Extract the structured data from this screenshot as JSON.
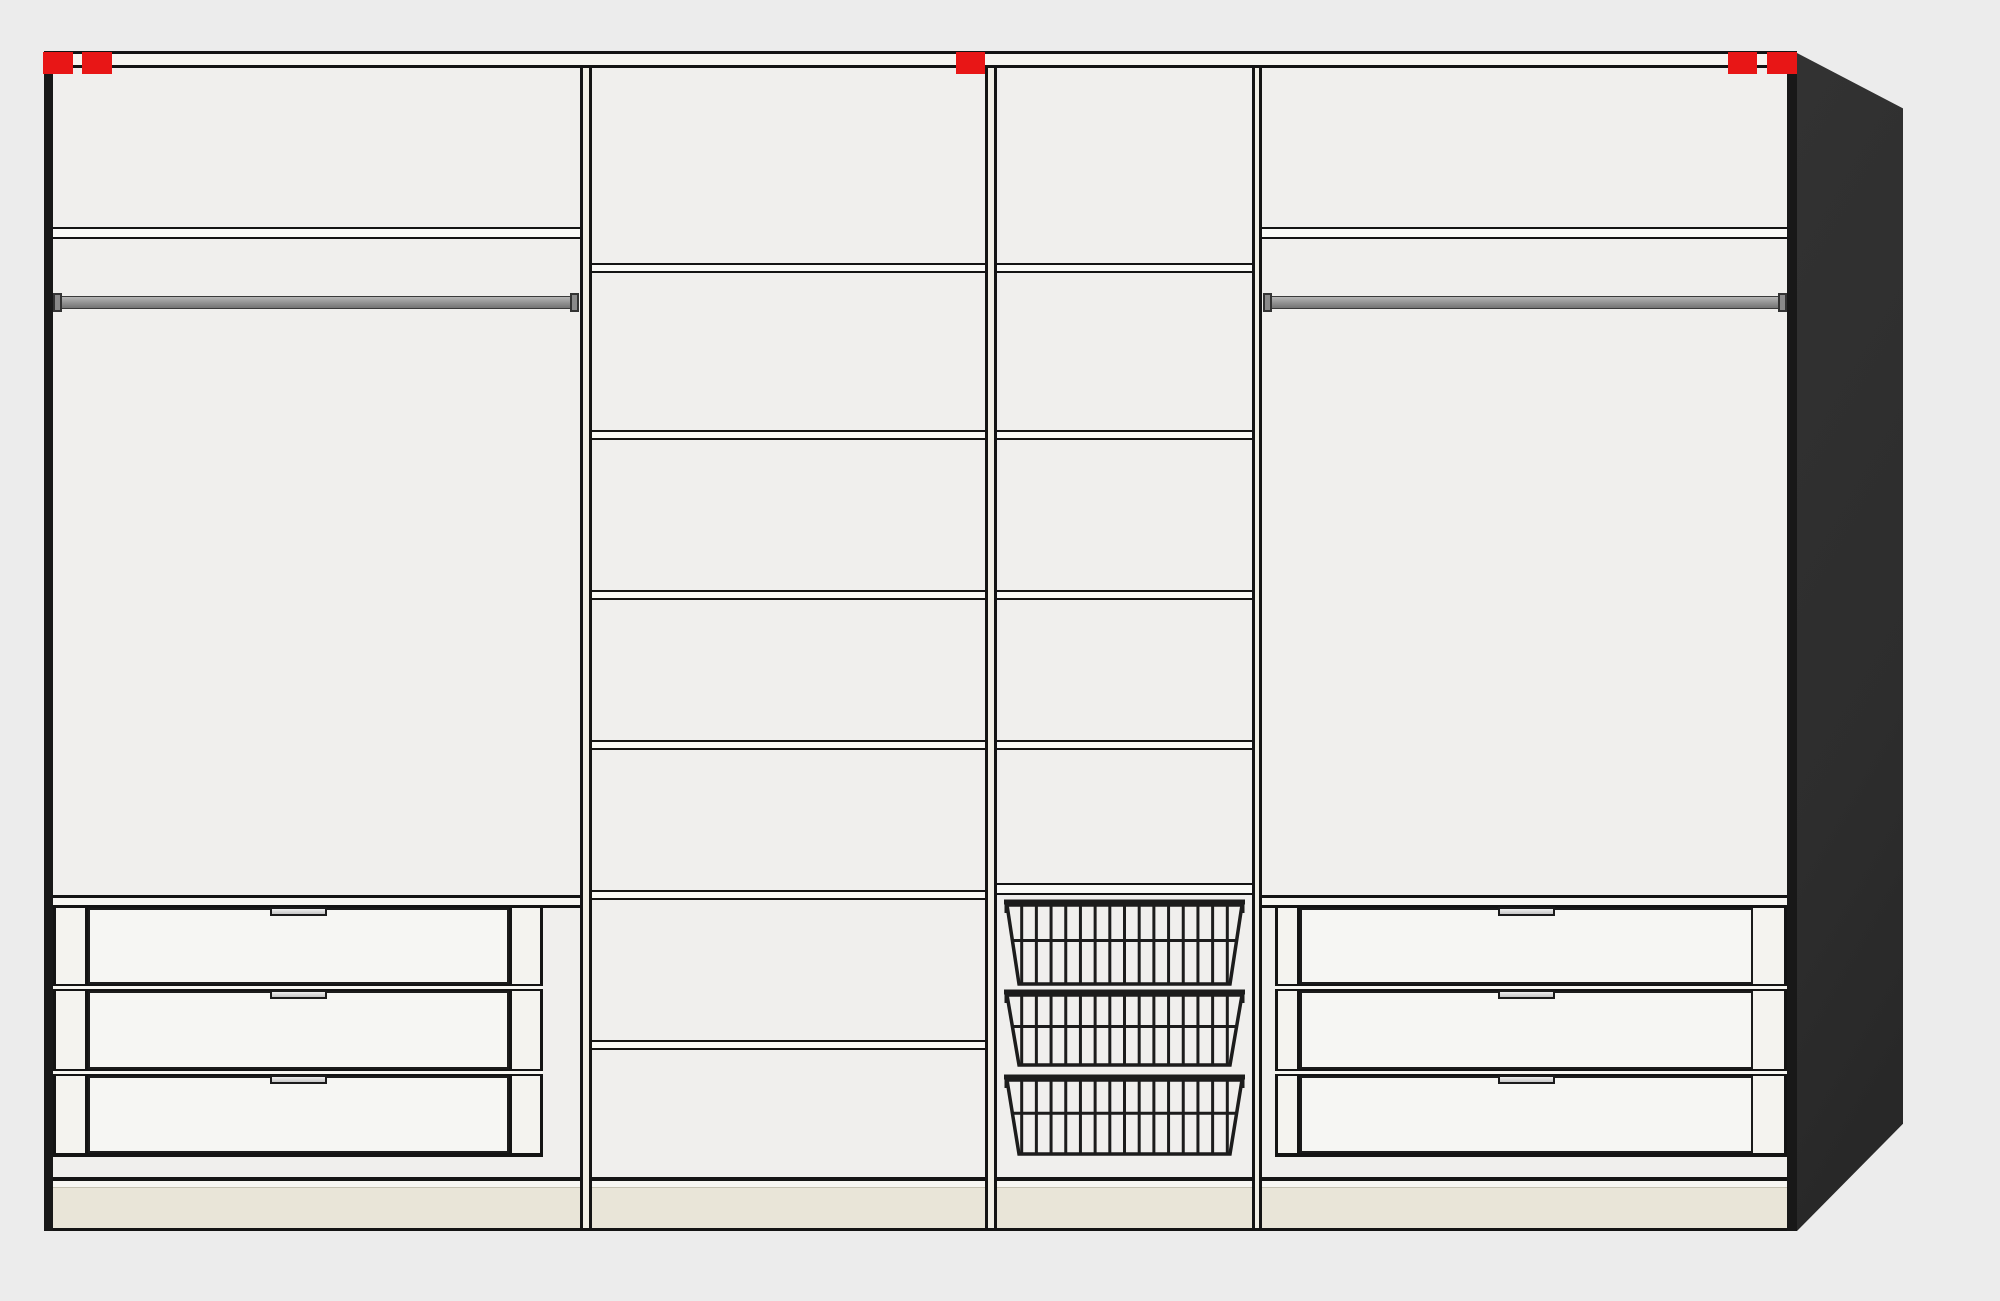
{
  "app": {
    "view": "wardrobe-front-elevation-preview",
    "description": "Schematic front view of a 4-section wardrobe interior with perspective side panel"
  },
  "palette": {
    "background": "#ececec",
    "interior": "#f0efed",
    "line_dark": "#141414",
    "wall_dark": "#181818",
    "carcass_white": "#f6f5f0",
    "divider_fill": "#f1efe6",
    "shelf_fill": "#fafaf7",
    "front_fill": "#f6f6f3",
    "column_fill": "#f4f3ef",
    "rail_band_fill": "#f7f6f2",
    "plinth_beige": "#e9e5d8",
    "plinth_edge": "#c5c1b2",
    "side_panel_dark": "#2d2d2d",
    "rod_light": "#b5b5b5",
    "rod_mid": "#909090",
    "rod_dark": "#747474",
    "rod_cap": "#8a8a8a",
    "handle_light": "#eeeeee",
    "handle_dark": "#c6c6c6",
    "marker_red": "#e81616",
    "basket_stroke": "#1c1c1c"
  },
  "canvas": {
    "width": 2000,
    "height": 1301
  },
  "wardrobe": {
    "frame": {
      "front_x": 44,
      "front_right": 1797,
      "top_band": {
        "x": 44,
        "y": 51,
        "w": 1753,
        "h": 17
      },
      "left_wall": {
        "x": 44,
        "y": 51,
        "w": 9,
        "h": 1180
      },
      "right_wall": {
        "x": 1787,
        "y": 51,
        "w": 10,
        "h": 1180
      },
      "interior": {
        "x": 53,
        "y": 68,
        "w": 1734,
        "h": 1109
      },
      "bottom_rail": {
        "x": 53,
        "y": 1177,
        "w": 1734,
        "h": 11
      },
      "plinth": {
        "x": 53,
        "y": 1188,
        "w": 1734,
        "h": 40
      },
      "bottom_line": {
        "x": 44,
        "y": 1228,
        "w": 1753,
        "h": 3
      },
      "dividers": [
        {
          "x": 580,
          "w": 12,
          "y": 54,
          "h": 1174
        },
        {
          "x": 985,
          "w": 12,
          "y": 54,
          "h": 1174
        },
        {
          "x": 1252,
          "w": 10,
          "y": 54,
          "h": 1174
        }
      ]
    },
    "side_panel": {
      "x": 1797,
      "y": 53,
      "w": 106,
      "h": 1178,
      "top_drop_pct": 4.7,
      "bottom_rise_pct": 90.9
    },
    "markers": [
      {
        "x": 43,
        "y": 52,
        "w": 30,
        "h": 22
      },
      {
        "x": 82,
        "y": 52,
        "w": 30,
        "h": 22
      },
      {
        "x": 956,
        "y": 52,
        "w": 29,
        "h": 22
      },
      {
        "x": 1728,
        "y": 52,
        "w": 29,
        "h": 22
      },
      {
        "x": 1767,
        "y": 52,
        "w": 30,
        "h": 22
      }
    ],
    "sections": [
      {
        "id": "hanging-left",
        "x": 53,
        "w": 527,
        "shelf": {
          "y": 227,
          "h": 12
        },
        "rail": {
          "body": {
            "x": 60,
            "y": 296,
            "w": 512,
            "h": 13
          },
          "caps": [
            {
              "x": 53,
              "y": 293,
              "w": 9,
              "h": 19
            },
            {
              "x": 570,
              "y": 293,
              "w": 9,
              "h": 19
            }
          ]
        },
        "drawer_unit": {
          "top_rail": {
            "x": 53,
            "y": 895,
            "w": 527,
            "h": 13
          },
          "top": 908,
          "bottom": 1153,
          "left_col": {
            "x": 53,
            "w": 35
          },
          "right_col": {
            "x": 509,
            "w": 34
          },
          "fronts_x": 88,
          "fronts_w": 421,
          "rows": [
            {
              "y": 908,
              "h": 76
            },
            {
              "y": 991,
              "h": 78
            },
            {
              "y": 1076,
              "h": 77
            }
          ],
          "rails": [
            {
              "y": 984,
              "h": 7
            },
            {
              "y": 1069,
              "h": 7
            }
          ],
          "rails_x": 53,
          "rails_w": 490,
          "handle": {
            "x": 270,
            "w": 57,
            "h": 9
          }
        }
      },
      {
        "id": "shelf-column",
        "x": 592,
        "w": 393,
        "shelf_h": 10,
        "shelves": [
          {
            "y": 263
          },
          {
            "y": 430
          },
          {
            "y": 590
          },
          {
            "y": 740
          },
          {
            "y": 890
          },
          {
            "y": 1040
          }
        ]
      },
      {
        "id": "basket-column",
        "x": 997,
        "w": 255,
        "shelf_h": 10,
        "shelves": [
          {
            "y": 263
          },
          {
            "y": 430
          },
          {
            "y": 590
          },
          {
            "y": 740
          }
        ],
        "thick_shelf": {
          "y": 883,
          "h": 12
        },
        "baskets": [
          {
            "y": 898,
            "h": 89
          },
          {
            "y": 988,
            "h": 80
          },
          {
            "y": 1073,
            "h": 84
          }
        ],
        "basket_style": {
          "bars": 15,
          "rail_stroke": 5,
          "stroke": 3
        }
      },
      {
        "id": "hanging-right",
        "x": 1262,
        "w": 525,
        "shelf": {
          "y": 227,
          "h": 12
        },
        "rail": {
          "body": {
            "x": 1271,
            "y": 296,
            "w": 510,
            "h": 13
          },
          "caps": [
            {
              "x": 1263,
              "y": 293,
              "w": 9,
              "h": 19
            },
            {
              "x": 1778,
              "y": 293,
              "w": 9,
              "h": 19
            }
          ]
        },
        "drawer_unit": {
          "top_rail": {
            "x": 1262,
            "y": 895,
            "w": 525,
            "h": 13
          },
          "top": 908,
          "bottom": 1153,
          "left_col": {
            "x": 1275,
            "w": 25
          },
          "right_col": {
            "x": 1750,
            "w": 37
          },
          "fronts_x": 1300,
          "fronts_w": 453,
          "rows": [
            {
              "y": 908,
              "h": 76
            },
            {
              "y": 991,
              "h": 78
            },
            {
              "y": 1076,
              "h": 77
            }
          ],
          "rails": [
            {
              "y": 984,
              "h": 7
            },
            {
              "y": 1069,
              "h": 7
            }
          ],
          "rails_x": 1275,
          "rails_w": 512,
          "handle": {
            "x": 1498,
            "w": 57,
            "h": 9
          }
        }
      }
    ]
  }
}
